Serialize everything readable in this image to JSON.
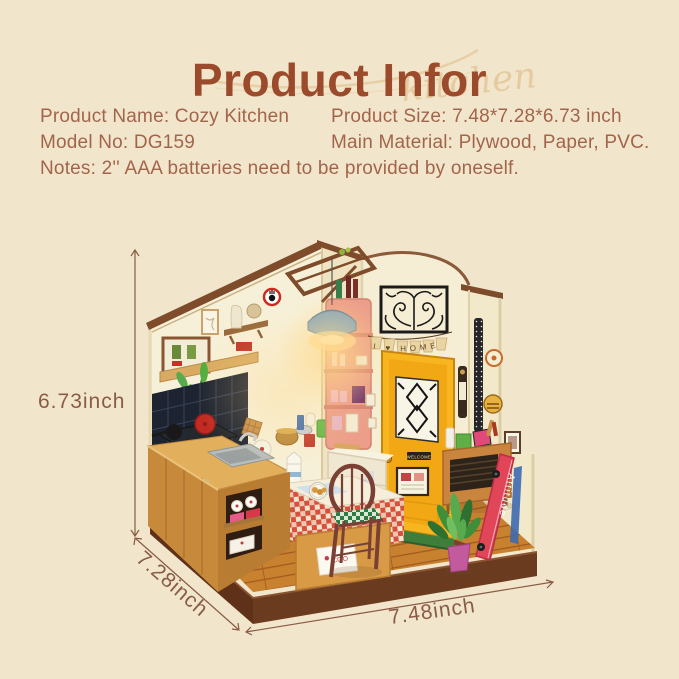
{
  "page": {
    "title": "Product Infor",
    "watermark": "kitchen",
    "background_color": "#f1e6cc"
  },
  "info": {
    "product_name": "Product Name: Cozy Kitchen",
    "model_no": "Model No: DG159",
    "product_size": "Product Size: 7.48*7.28*6.73 inch",
    "main_material": "Main Material: Plywood, Paper, PVC.",
    "notes": "Notes: 2'' AAA batteries need to be provided by oneself."
  },
  "dimensions": {
    "height_label": "6.73inch",
    "depth_label": "7.28inch",
    "width_label": "7.48inch"
  },
  "model": {
    "banner_text": "I ♥ HOME",
    "door_plate_text": "WELCOME",
    "skateboard_text": "Attitude",
    "table_card_text": "COO"
  },
  "colors": {
    "title_text": "#9c4a2c",
    "body_text": "#a2654b",
    "dimension_text": "#8a5c46",
    "watermark": "#e6cba1",
    "wall_cream": "#f7f0d8",
    "entry_wall": "#f6eed4",
    "facade_cream": "#f2e8ca",
    "door_yellow": "#f2a714",
    "door_frame_yellow": "#f7b51f",
    "shelf_pink": "#ec9e8b",
    "counter_wood": "#c78a3a",
    "floor_wood": "#c8812f",
    "base_brown": "#6b3b20",
    "skateboard_red": "#e04558",
    "tablecloth_red": "#d6503e",
    "cushion_green": "#2f7b46",
    "plant_green": "#3f8f3a",
    "lamp_blue": "#7fa3c0",
    "trim_brown": "#7e4c2a"
  }
}
